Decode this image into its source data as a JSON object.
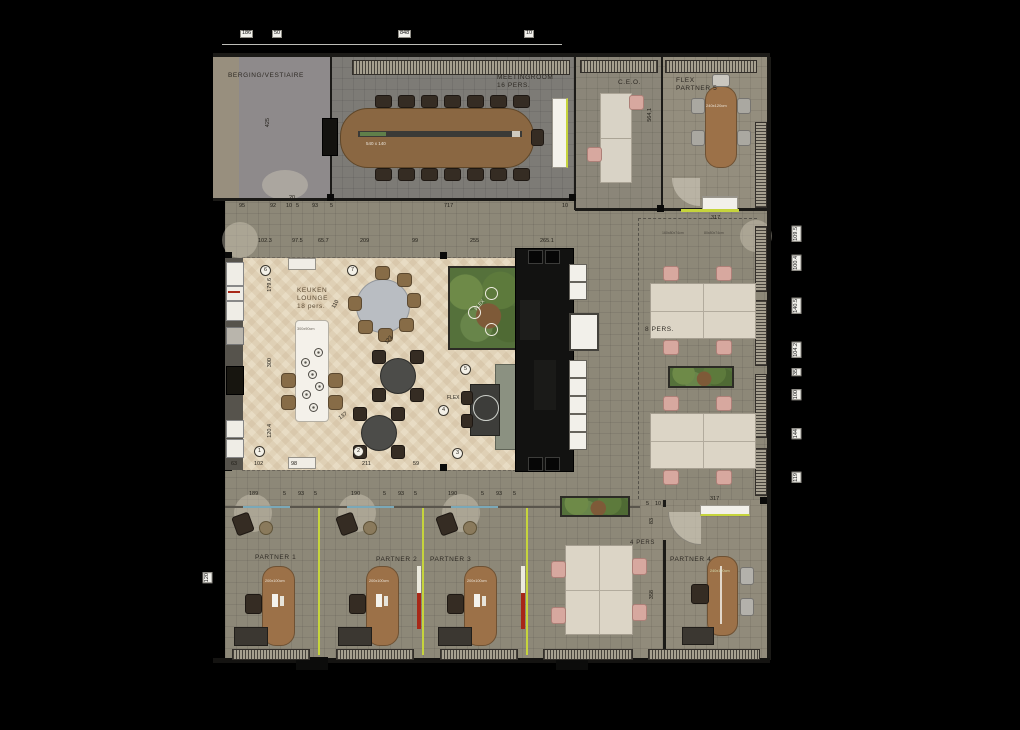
{
  "rooms": {
    "berging": {
      "label": "BERGING/VESTIAIRE"
    },
    "meeting": {
      "label": "MEETINGROOM",
      "sub": "16 PERS.",
      "table_label": "540 x 140"
    },
    "ceo": {
      "label": "C.E.O."
    },
    "flex5": {
      "label": "FLEX",
      "sub": "PARTNER 5",
      "table_label": "240x120cm"
    },
    "keuken": {
      "label": "KEUKEN",
      "sub": "LOUNGE",
      "sub2": "18 pers.",
      "island_label": "300x90cm"
    },
    "flex_zone": {
      "planter_label": "FLEX",
      "booth_label": "FLEX"
    },
    "eight_pers": {
      "label": "8 PERS."
    },
    "four_pers": {
      "label": "4 PERS"
    },
    "partner1": {
      "label": "PARTNER 1",
      "desk_label": "200x100cm"
    },
    "partner2": {
      "label": "PARTNER 2",
      "desk_label": "200x100cm"
    },
    "partner3": {
      "label": "PARTNER 3",
      "desk_label": "200x100cm"
    },
    "partner4": {
      "label": "PARTNER 4",
      "desk_label": "240x120cm"
    }
  },
  "dims": {
    "top": [
      "186",
      "50",
      "848",
      "10"
    ],
    "row1": [
      "95",
      "92",
      "10",
      "5",
      "93",
      "5",
      "717",
      "10"
    ],
    "row2": [
      "102.3",
      "97.5",
      "65.7",
      "209",
      "99",
      "255",
      "265.1"
    ],
    "corridor_note": "20",
    "lounge_left": [
      "179.6",
      "300",
      "120.4"
    ],
    "lounge_diag": [
      "110",
      "123",
      "137"
    ],
    "lounge_bottom": [
      "63",
      "102",
      "98",
      "211",
      "59"
    ],
    "partner_row": [
      "189",
      "5",
      "93",
      "5",
      "190",
      "5",
      "93",
      "5",
      "190",
      "5",
      "93",
      "5"
    ],
    "right_edge": [
      "109.5",
      "100.4",
      "140.5",
      "104.2",
      "35",
      "100",
      "144",
      "119"
    ],
    "misc": {
      "berging_h": "425",
      "ceo_h": "564,1",
      "top_317": "317",
      "bottom_317": "317",
      "p4_5": "5",
      "p4_10": "10",
      "p4_83": "83",
      "p4_358": "358",
      "left_120": "120"
    },
    "desk_specs": [
      "160x80x74cm",
      "80x80x74cm"
    ]
  },
  "markers": [
    "1",
    "2",
    "3",
    "4",
    "5",
    "6",
    "7"
  ],
  "colors": {
    "accent_green": "#c6d43c",
    "accent_red": "#a82818",
    "accent_teal": "#7aa8b8",
    "wood": "#9c7148",
    "desk_cream": "#dcd5c6",
    "chair_pink": "#d7a89f"
  }
}
